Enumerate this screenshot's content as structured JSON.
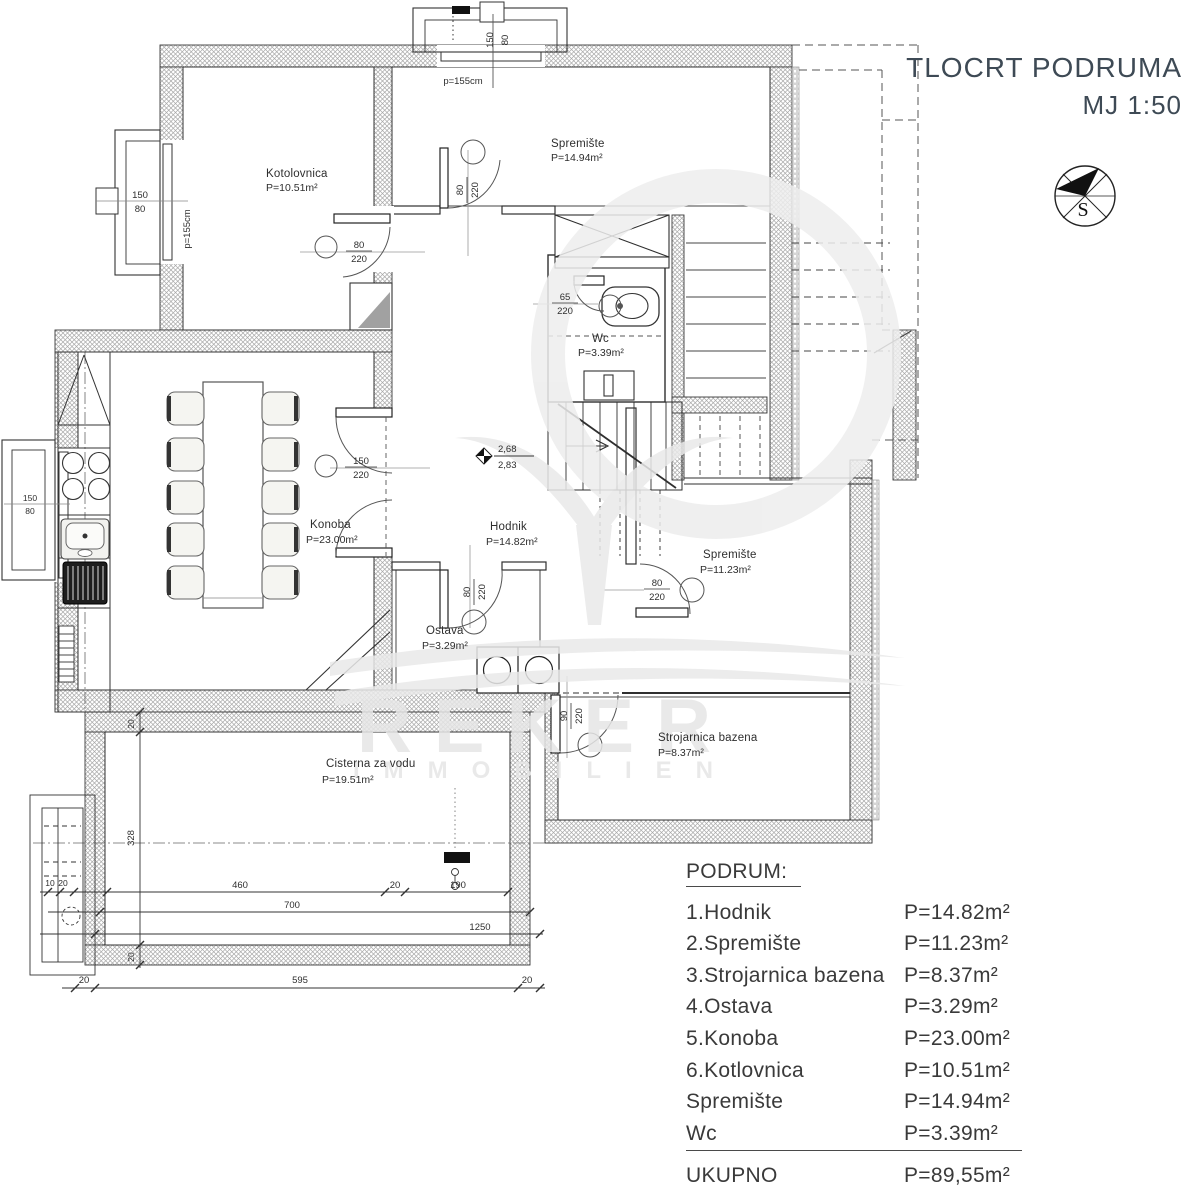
{
  "title": {
    "line1": "TLOCRT PODRUMA",
    "line2": "MJ 1:50"
  },
  "compass": {
    "label": "S"
  },
  "watermark": {
    "line1": "REKER",
    "line2": "IMMOBILIEN"
  },
  "rooms": {
    "kotlovnica": {
      "name": "Kotolovnica",
      "area": "P=10.51m²"
    },
    "spremiste_top": {
      "name": "Spremište",
      "area": "P=14.94m²"
    },
    "wc": {
      "name": "Wc",
      "area": "P=3.39m²"
    },
    "hodnik": {
      "name": "Hodnik",
      "area": "P=14.82m²"
    },
    "konoba": {
      "name": "Konoba",
      "area": "P=23.00m²"
    },
    "ostava": {
      "name": "Ostava",
      "area": "P=3.29m²"
    },
    "spremiste_right": {
      "name": "Spremište",
      "area": "P=11.23m²"
    },
    "strojarnica": {
      "name": "Strojarnica bazena",
      "area": "P=8.37m²"
    },
    "cisterna": {
      "name": "Cisterna za vodu",
      "area": "P=19.51m²"
    }
  },
  "door_dims": {
    "w80": "80",
    "w65": "65",
    "w150": "150",
    "w90": "90",
    "h220": "220"
  },
  "window_dims": {
    "w150": "150",
    "h80": "80",
    "parapet": "p=155cm"
  },
  "elevation": {
    "upper": "2,68",
    "lower": "2,83"
  },
  "lin_dims": {
    "d460": "460",
    "d20": "20",
    "d190": "190",
    "d700": "700",
    "d1250": "1250",
    "d595": "595",
    "d328": "328",
    "d10": "10"
  },
  "legend": {
    "heading": "PODRUM:",
    "rows": [
      {
        "label": "1.Hodnik",
        "value": "P=14.82m²"
      },
      {
        "label": "2.Spremište",
        "value": "P=11.23m²"
      },
      {
        "label": "3.Strojarnica bazena",
        "value": "P=8.37m²"
      },
      {
        "label": "4.Ostava",
        "value": "P=3.29m²"
      },
      {
        "label": "5.Konoba",
        "value": "P=23.00m²"
      },
      {
        "label": "6.Kotlovnica",
        "value": "P=10.51m²"
      },
      {
        "label": "Spremište",
        "value": "P=14.94m²"
      },
      {
        "label": "Wc",
        "value": "P=3.39m²"
      }
    ],
    "total": {
      "label": "UKUPNO",
      "value": "P=89,55m²"
    }
  },
  "colors": {
    "title": "#3e4a55",
    "line": "#2f2f2f",
    "hatch": "#a8a8a8",
    "watermark": "#e6e6e6"
  }
}
